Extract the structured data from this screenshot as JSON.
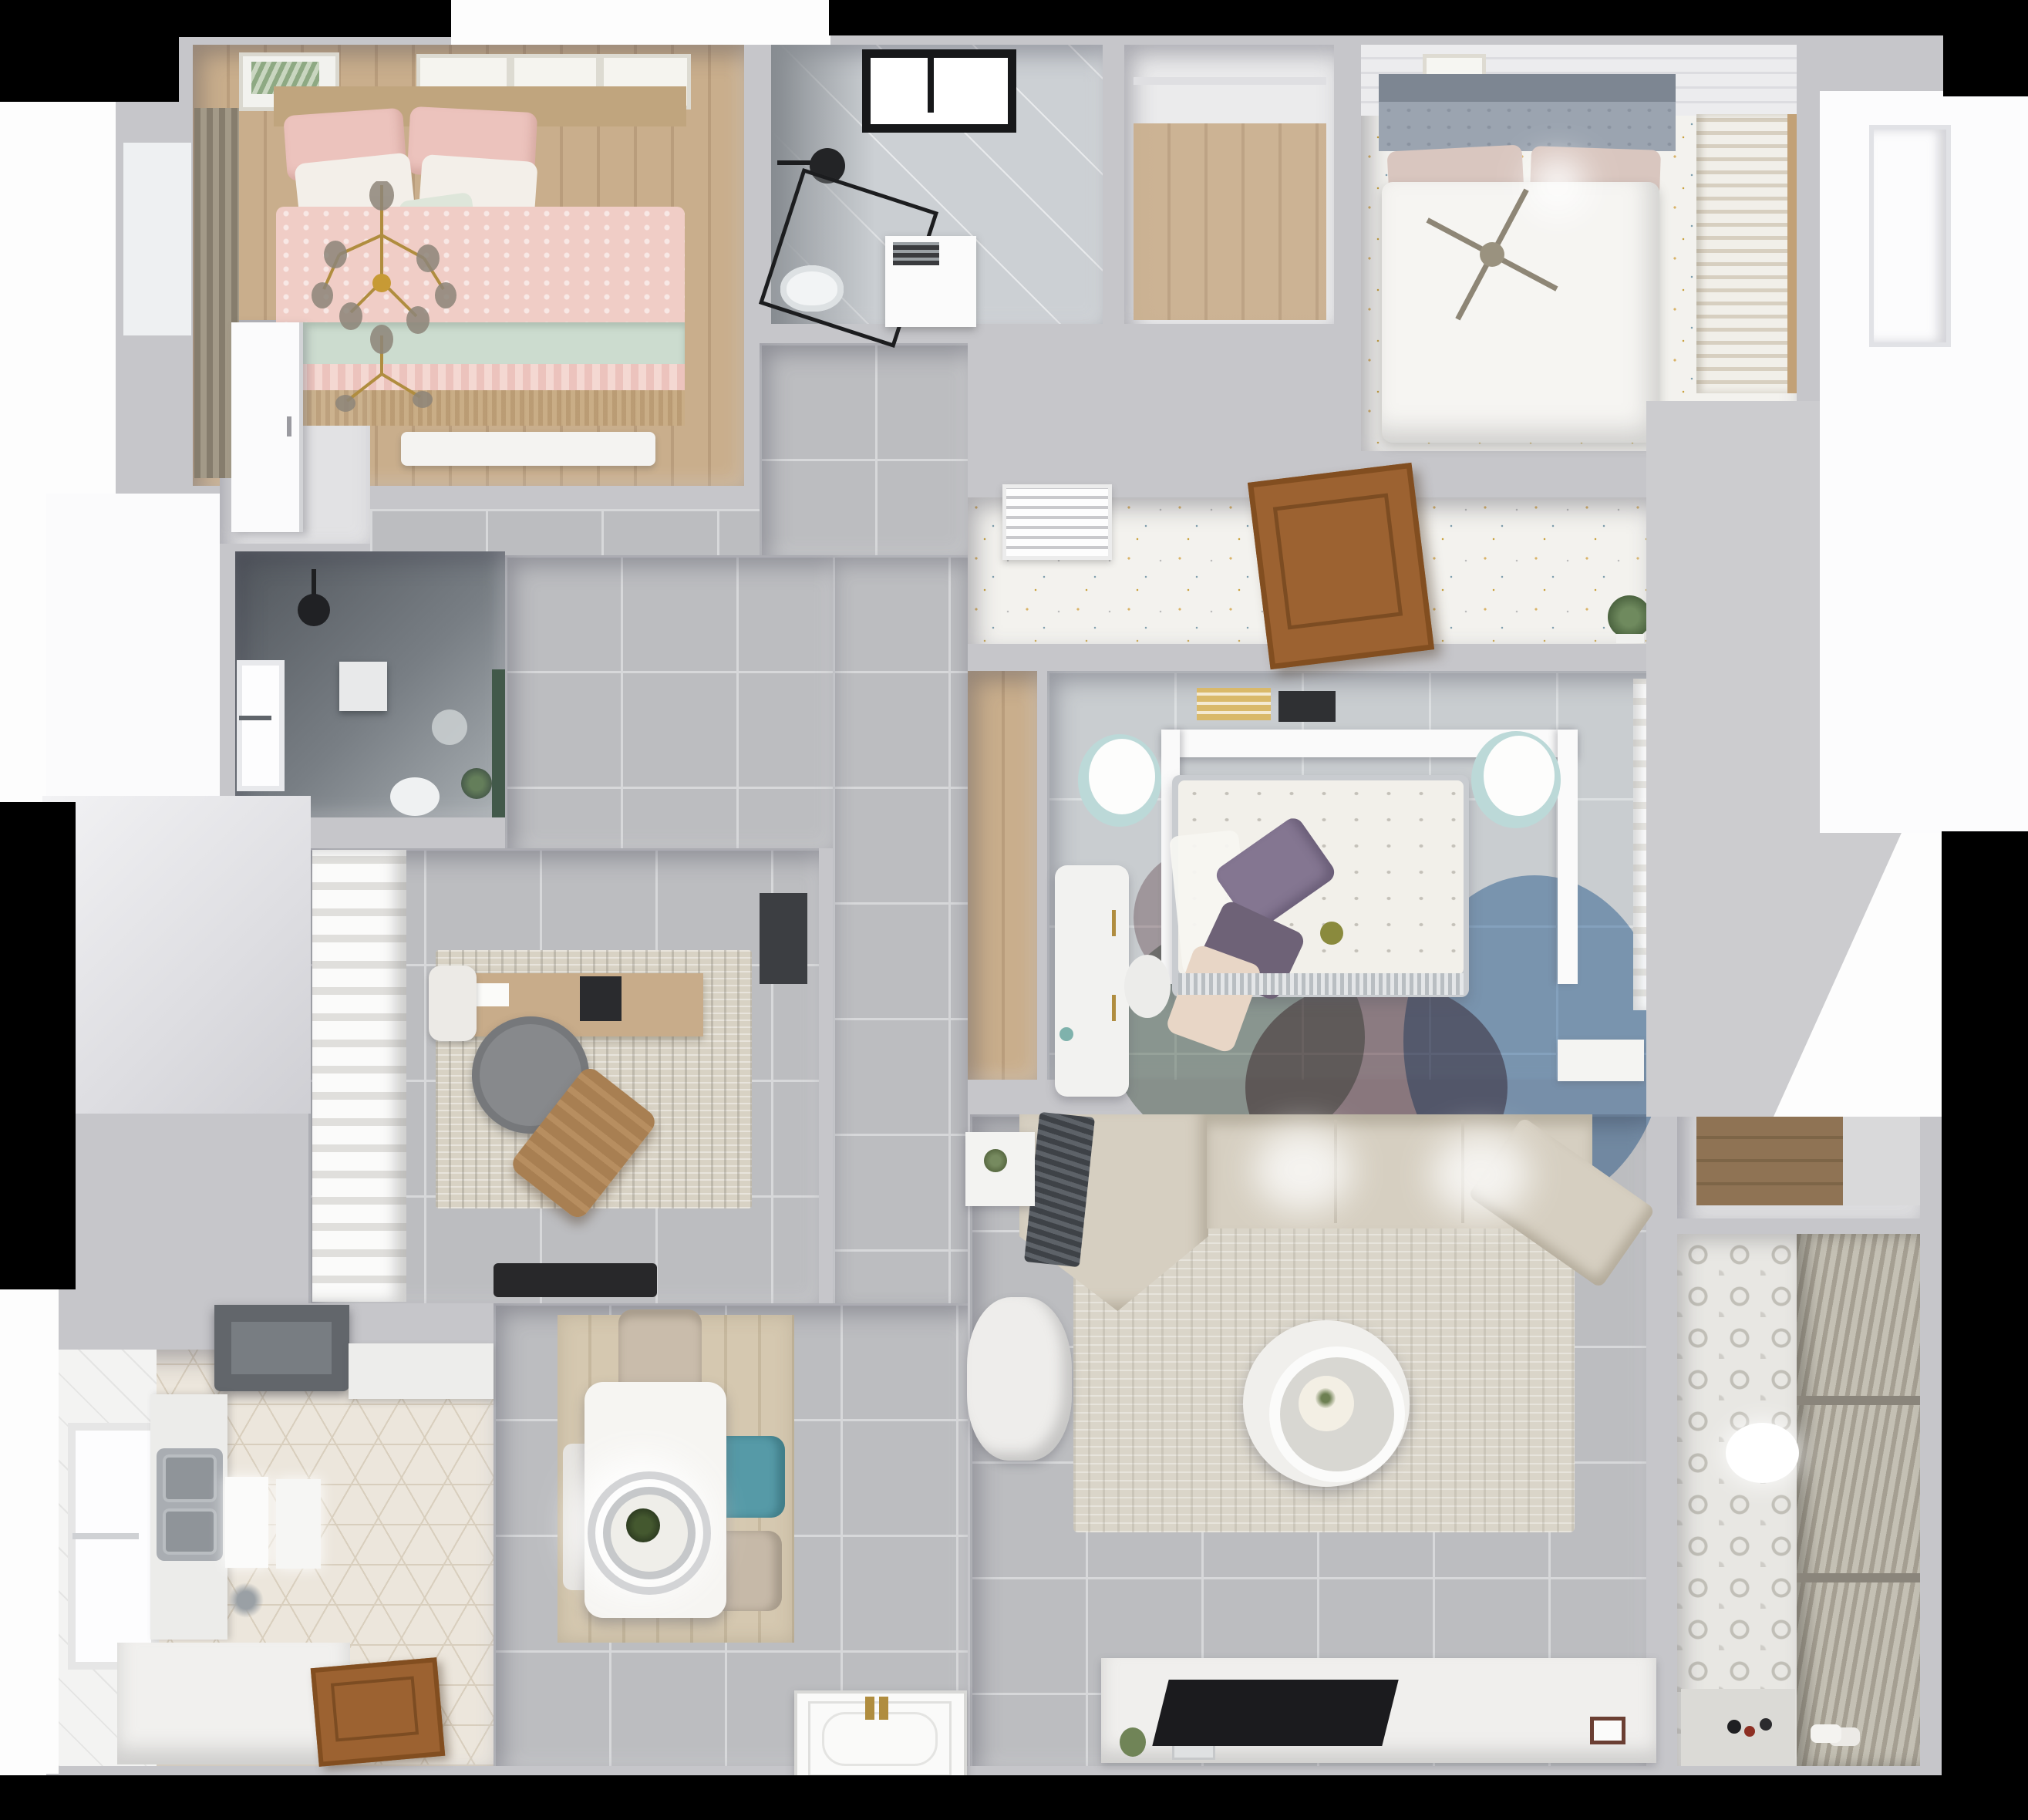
{
  "scene": {
    "type": "3d-floorplan-top-down-render",
    "description": "bird's-eye dollhouse render of a furnished apartment",
    "background": "#000000",
    "canvas": "#fdfdfd"
  },
  "palette": {
    "black": "#000000",
    "canvas": "#fdfdfd",
    "wall": "#c6c6ca",
    "wallLight": "#dcdcdf",
    "wallLit": "#ececee",
    "tile": "#bcbdc0",
    "tileLine": "#d7d8da",
    "tileBlue": "#c9cdd0",
    "marble": "#ccd0d4",
    "woodTan": "#c9ae8c",
    "woodMid": "#c8ac8a",
    "woodDine": "#d5c8b0",
    "woodDark": "#8f7354",
    "woodDoor": "#9c6231",
    "confetti": "#f3f2ee",
    "pink": "#f0cdc6",
    "pinkDeep": "#ecc3bd",
    "mint": "#ccdccf",
    "tan": "#c0a57e",
    "bedWhite": "#f6f5f2",
    "teal": "#569aa7",
    "tealLight": "#bcd9d8",
    "purple": "#847691",
    "purple2": "#6e6277",
    "rugBlue": "#7fa6cc",
    "rugMauve": "#96777d",
    "rugSage": "#9aa79b",
    "rugBlush": "#e8d6c6",
    "sofa": "#d6cfc1",
    "rugLiving": "#dad5c9",
    "throw": "#454a50",
    "rugStudy": "#d8d2c4",
    "hex": "#ece6dc",
    "hexLine": "#d8cebd",
    "darkBath": "#585d63",
    "green": "#5d7d54",
    "gold": "#b08d3f",
    "steel": "#a9adb2",
    "hood": "#62666b",
    "tv": "#1b1b1e",
    "blinds": "#a59f92",
    "blindsLight": "#c4c0b4"
  },
  "rooms": [
    {
      "id": "bedroom-pink",
      "floor": "wood-plank",
      "furniture": [
        "double-bed-pink",
        "mint-throw",
        "wall-art-frames",
        "window-curtains",
        "gold-chandelier",
        "foot-bench",
        "fringe-runner"
      ]
    },
    {
      "id": "bathroom-ensuite",
      "floor": "marble",
      "furniture": [
        "black-frame-shower",
        "shower-head",
        "toilet",
        "storage-unit",
        "black-frame-window"
      ]
    },
    {
      "id": "laundry-closet",
      "floor": "wood-plank"
    },
    {
      "id": "bedroom-master",
      "floor": "terrazzo-dots",
      "furniture": [
        "double-bed-white",
        "tufted-headboard",
        "blush-pillows",
        "ceiling-fan",
        "louver-wardrobe",
        "wall-art"
      ]
    },
    {
      "id": "hallway",
      "floor": "gray-tile"
    },
    {
      "id": "corridor",
      "floor": "terrazzo-dots",
      "furniture": [
        "ac-vent-grille",
        "open-wood-door",
        "potted-plant"
      ]
    },
    {
      "id": "bathroom-dark",
      "floor": "dark-stone",
      "furniture": [
        "ceiling-shower-head",
        "window",
        "wall-cabinet",
        "toilet",
        "green-accent-wall",
        "plant"
      ]
    },
    {
      "id": "study",
      "floor": "gray-tile",
      "furniture": [
        "ruffle-curtains",
        "desk",
        "laptop",
        "desk-chair",
        "round-lounge-chair",
        "wood-recliner",
        "area-rug",
        "wall-panel",
        "door-mat"
      ]
    },
    {
      "id": "bedroom-center",
      "floor": "light-tile",
      "furniture": [
        "double-bed-floral",
        "purple-pillows",
        "headboard-shelf-books",
        "pouf-left",
        "pouf-right",
        "vanity-desk",
        "vanity-chair",
        "overlap-circle-rug",
        "sheer-closet-curtains",
        "nightstand"
      ]
    },
    {
      "id": "living-room",
      "floor": "gray-tile",
      "furniture": [
        "corner-sofa",
        "striped-throw",
        "area-rug",
        "round-coffee-table",
        "armchair",
        "side-table-plant",
        "tv-console",
        "console-decor",
        "tv-panel"
      ]
    },
    {
      "id": "kitchen",
      "floor": "hex-tile",
      "furniture": [
        "range-hood",
        "counter-top",
        "double-sink",
        "lit-cabinet-doors",
        "island-counter",
        "window",
        "wood-door"
      ]
    },
    {
      "id": "dining",
      "floor": "wood-plank",
      "furniture": [
        "dining-table",
        "pendant-lamp-rings",
        "centerpiece-plant",
        "chair-north",
        "chair-west",
        "chair-teal",
        "chair-south"
      ]
    },
    {
      "id": "balcony",
      "floor": "pattern-tile",
      "furniture": [
        "roller-blinds",
        "ceiling-light",
        "floor-toys",
        "slippers"
      ]
    },
    {
      "id": "storage-nook",
      "floor": "wood-plank"
    },
    {
      "id": "entry",
      "furniture": [
        "ornate-front-door-panel",
        "white-door-vestibule",
        "white-door-exterior"
      ]
    }
  ]
}
